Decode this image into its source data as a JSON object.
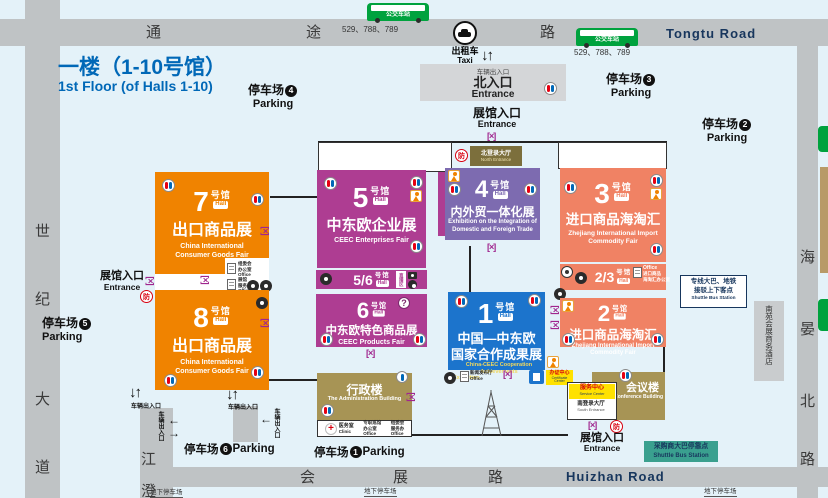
{
  "title": {
    "line1": "一楼（1-10号馆）",
    "line2": "1st Floor (of Halls 1-10)"
  },
  "roads": {
    "top_char1": "通",
    "top_char2": "途",
    "top_char3": "路",
    "top_name": "Tongtu Road",
    "bottom_char1": "会",
    "bottom_char2": "展",
    "bottom_char3": "路",
    "bottom_name": "Huizhan Road",
    "left_char1": "世",
    "left_char2": "纪",
    "left_char3": "大",
    "left_char4": "道",
    "right_char1": "海",
    "right_char2": "晏",
    "right_char3": "北",
    "right_char4": "路",
    "inner_char1": "江",
    "inner_char2": "澄"
  },
  "bus": {
    "station": "公交车站",
    "routes": "529、788、789"
  },
  "taxi": {
    "zh": "出租车",
    "en": "Taxi"
  },
  "parking": {
    "word": "停车场",
    "en": "Parking",
    "n1": "1",
    "n2": "2",
    "n3": "3",
    "n4": "4",
    "n5": "5",
    "n6": "6"
  },
  "labels": {
    "hall_entrance_zh": "展馆入口",
    "hall_entrance_en": "Entrance",
    "north_entrance_zh": "北入口",
    "north_entrance_en": "Entrance",
    "vehicle_gate": "车辆出入口",
    "underground": "地下停车场",
    "fang": "防",
    "live": "直播区"
  },
  "lobby": {
    "north_zh": "北登录大厅",
    "north_en": "North Entrance",
    "south_zh": "南登录大厅",
    "south_en": "South Entrance"
  },
  "halls": {
    "h7": {
      "num": "7",
      "unit": "号馆",
      "hall": "Hall",
      "title": "出口商品展",
      "en1": "China International",
      "en2": "Consumer Goods Fair"
    },
    "h8": {
      "num": "8",
      "unit": "号馆",
      "hall": "Hall",
      "title": "出口商品展",
      "en1": "China International",
      "en2": "Consumer Goods Fair"
    },
    "h5": {
      "num": "5",
      "unit": "号馆",
      "hall": "Hall",
      "title": "中东欧企业展",
      "en1": "CEEC Enterprises Fair"
    },
    "h56": {
      "num": "5/6",
      "unit": "号馆",
      "hall": "Hall"
    },
    "h6": {
      "num": "6",
      "unit": "号馆",
      "hall": "Hall",
      "title": "中东欧特色商品展",
      "en1": "CEEC Products Fair"
    },
    "h4": {
      "num": "4",
      "unit": "号馆",
      "hall": "Hall",
      "title": "内外贸一体化展",
      "en1": "Exhibition on the Integration of",
      "en2": "Domestic and Foreign Trade"
    },
    "h3": {
      "num": "3",
      "unit": "号馆",
      "hall": "Hall",
      "title": "进口商品海淘汇",
      "en1": "Zhejiang International Import",
      "en2": "Commodity Fair"
    },
    "h23": {
      "num": "2/3",
      "unit": "号馆",
      "hall": "Hall"
    },
    "h2": {
      "num": "2",
      "unit": "号馆",
      "hall": "Hall",
      "title": "进口商品海淘汇",
      "en1": "Zhejiang International Import",
      "en2": "Commodity Fair"
    },
    "h1": {
      "num": "1",
      "unit": "号馆",
      "hall": "Hall",
      "title1": "中国—中东欧",
      "title2": "国家合作成果展",
      "en1": "China-CEEC Cooperation Achievements",
      "en2": "Exhibition"
    }
  },
  "buildings": {
    "admin_zh": "行政楼",
    "admin_en": "The Administration Building",
    "conf_zh": "会议楼",
    "conf_en": "The Conference Building",
    "service_zh": "服务中心",
    "service_en": "Service Center",
    "cert_zh": "办证中心",
    "cert_en": "Certificate Center",
    "hotel": "南苑会展商务酒店",
    "clinic_zh": "医务室",
    "clinic_en": "Clinic"
  },
  "offices": {
    "office_en": "Office",
    "o1a": "专职巡馆",
    "o1b": "办公室",
    "o2a": "组委会",
    "o2b": "服务办",
    "o3a": "组委会",
    "o3b": "办公室",
    "o4a": "展馆",
    "o4b": "服务办",
    "o5a": "进口商品",
    "o5b": "海淘汇办公室",
    "o6a": "新闻发布厅"
  },
  "shuttle": {
    "right1": "专线大巴、地铁",
    "right2": "接驳上下客点",
    "right3": "Shuttle Bus Station",
    "bottom1": "采购商大巴停靠点",
    "bottom2": "Shuttle Bus Station"
  },
  "colors": {
    "orange": "#F08300",
    "magenta": "#AE3D92",
    "purple": "#7D6BB0",
    "salmon": "#F08264",
    "blue": "#1C74CC",
    "khaki": "#A79455",
    "teal": "#3AA08F",
    "road": "#BFC3C5",
    "navy": "#17365D",
    "title_blue": "#0068B7",
    "yellow": "#FFE100",
    "red": "#D7000F",
    "green_bus": "#00A23E"
  }
}
